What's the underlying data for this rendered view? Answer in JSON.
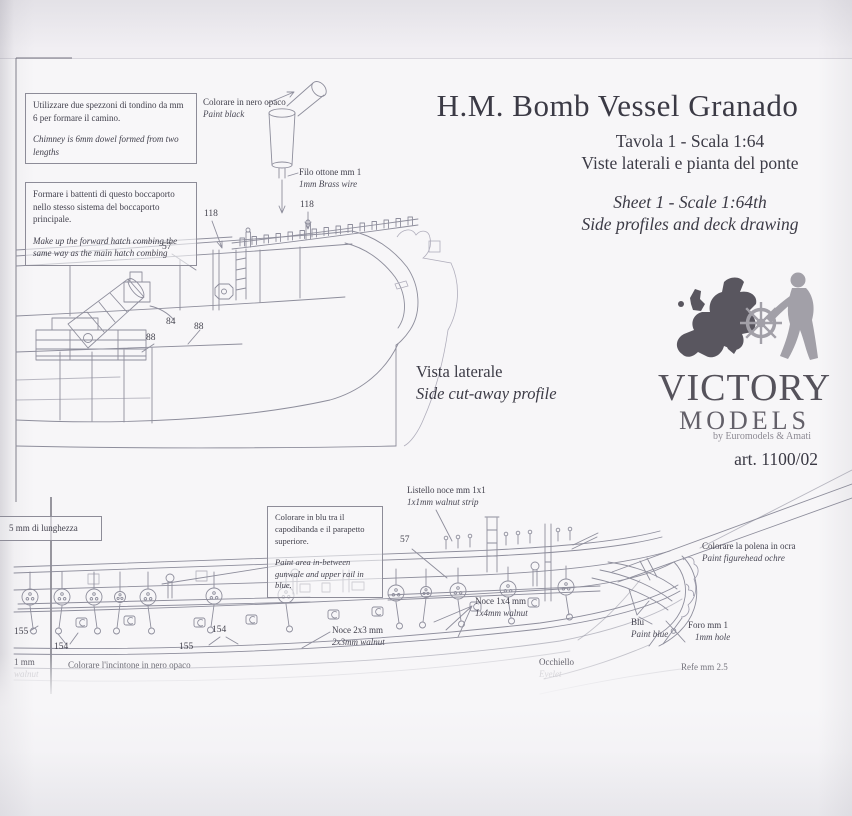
{
  "photo": {
    "paper_color": "#f7f6f8",
    "ink_color": "#42414d",
    "drawing_line_color": "#8e8e9c"
  },
  "title_block": {
    "title": "H.M. Bomb Vessel Granado",
    "line_it_1": "Tavola 1 - Scala 1:64",
    "line_it_2": "Viste laterali e pianta del ponte",
    "line_en_1": "Sheet 1 - Scale 1:64th",
    "line_en_2": "Side profiles and deck drawing"
  },
  "logo": {
    "name_top": "VICTORY",
    "name_bottom": "MODELS",
    "byline": "by Euromodels & Amati",
    "art_no": "art. 1100/02",
    "map_color": "#59565f",
    "figure_color": "#a2a0a8"
  },
  "upper_profile": {
    "caption": {
      "it": "Vista laterale",
      "en": "Side cut-away profile"
    },
    "note_chimney": {
      "it": "Utilizzare due spezzoni di tondino da mm 6 per formare il camino.",
      "en": "Chimney is 6mm dowel formed from two lengths"
    },
    "note_hatch": {
      "it": "Formare i battenti di questo boccaporto nello stesso sistema del boccaporto principale.",
      "en": "Make up the forward hatch combing the same way as the main hatch combing"
    },
    "lbl_paint_black": {
      "it": "Colorare in nero opaco",
      "en": "Paint black"
    },
    "lbl_brass_wire": {
      "it": "Filo ottone mm 1",
      "en": "1mm Brass wire"
    },
    "numbers": {
      "n57": "57",
      "n118a": "118",
      "n118b": "118",
      "n84": "84",
      "n88a": "88",
      "n88b": "88"
    }
  },
  "lower_profile": {
    "note_length": {
      "it": "5 mm di lunghezza"
    },
    "note_blue": {
      "it": "Colorare in blu tra il capodibanda e il parapetto superiore.",
      "en": "Paint area in-between gunwale and upper rail in blue."
    },
    "lbl_strip": {
      "it": "Listello noce mm 1x1",
      "en": "1x1mm walnut strip"
    },
    "lbl_figurehead": {
      "it": "Colorare la polena in ocra",
      "en": "Paint figurehead ochre"
    },
    "lbl_blue": {
      "it": "Blu",
      "en": "Paint blue"
    },
    "lbl_hole": {
      "it": "Foro mm 1",
      "en": "1mm hole"
    },
    "lbl_walnut_1x4": {
      "it": "Noce 1x4 mm",
      "en": "1x4mm walnut"
    },
    "lbl_walnut_2x3": {
      "it": "Noce 2x3 mm",
      "en": "2x3mm walnut"
    },
    "lbl_eyelet": {
      "it": "Occhiello",
      "en": "Eyelet"
    },
    "lbl_thread": {
      "it": "Refe mm 2.5"
    },
    "lbl_wale": {
      "it": "Colorare l'incintone in nero opaco"
    },
    "lbl_edge": {
      "it": "1 mm",
      "en": "walnut"
    },
    "numbers": {
      "n57": "57",
      "n155a": "155",
      "n154a": "154",
      "n155b": "155",
      "n154b": "154"
    }
  }
}
